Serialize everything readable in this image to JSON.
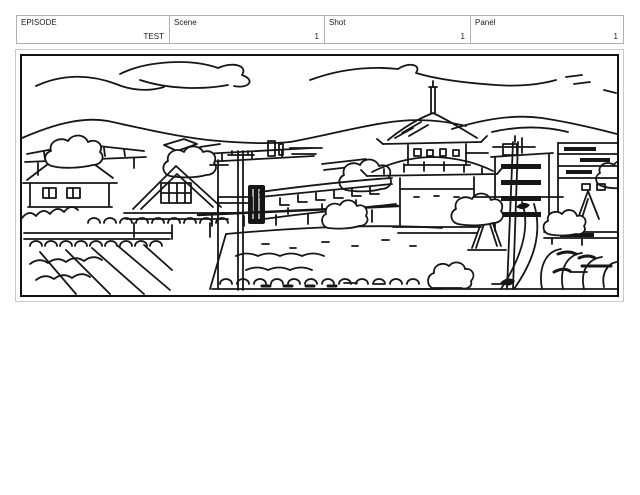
{
  "header": {
    "fields": [
      {
        "id": "episode",
        "label": "EPISODE",
        "value": "TEST"
      },
      {
        "id": "scene",
        "label": "Scene",
        "value": "1"
      },
      {
        "id": "shot",
        "label": "Shot",
        "value": "1"
      },
      {
        "id": "panel",
        "label": "Panel",
        "value": "1"
      }
    ]
  },
  "panel": {
    "description": "Black-and-white hand-drawn storyboard panel: a village townscape of tiled rooftops, trees and utility poles, with a pagoda temple and modern buildings in front of distant mountains under a sky with sketched clouds.",
    "ink_color": "#161616",
    "frame_color": "#111111",
    "outer_border_color": "#c9c9c9",
    "table_border_color": "#b0b0b0",
    "background_color": "#ffffff"
  }
}
